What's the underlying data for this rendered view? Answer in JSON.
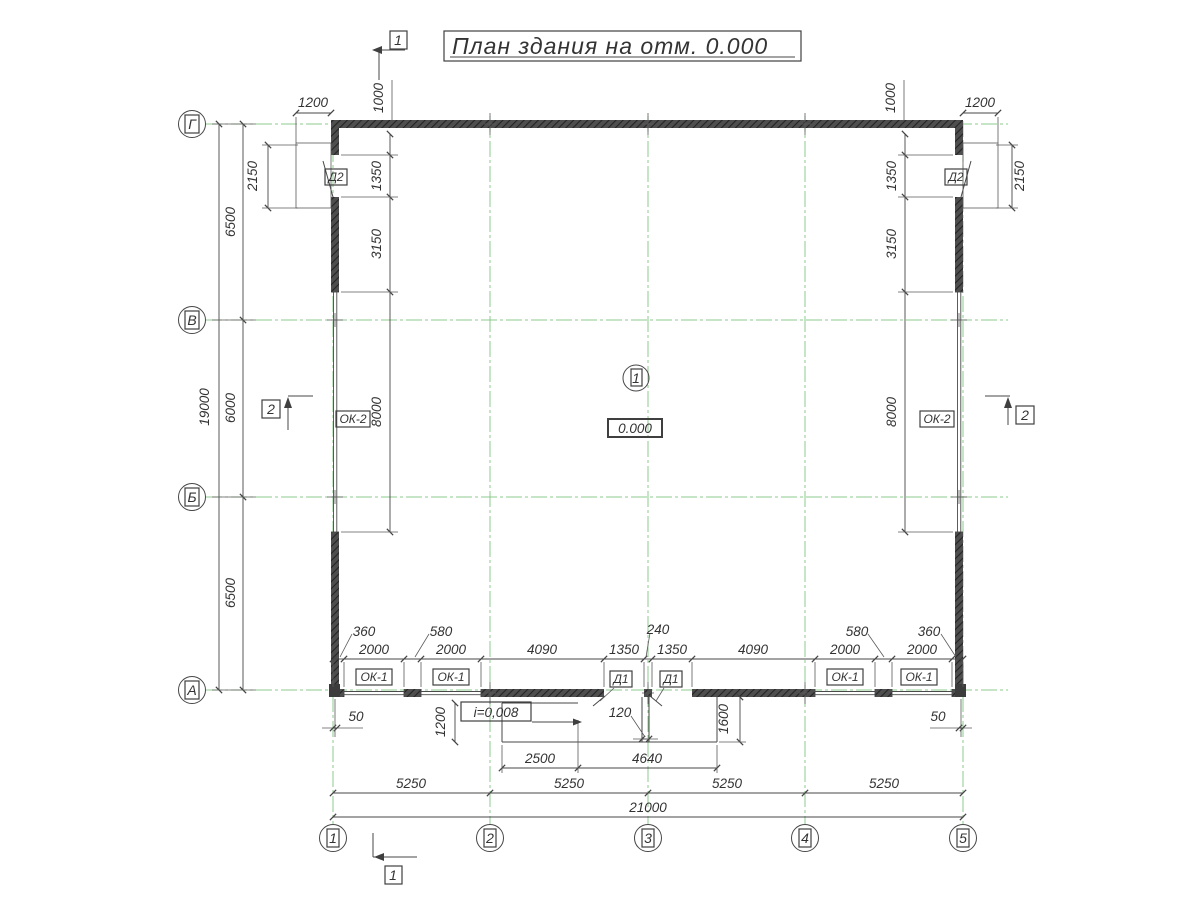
{
  "title": "План здания на отм. 0.000",
  "sections": {
    "s1": "1",
    "s2": "2"
  },
  "axes": {
    "vertical": [
      "Г",
      "В",
      "Б",
      "А"
    ],
    "horizontal": [
      "1",
      "2",
      "3",
      "4",
      "5"
    ]
  },
  "labels": {
    "room_number": "1",
    "elevation": "0.000",
    "slope": "i=0,008",
    "door_main": "Д1",
    "door_side": "Д2",
    "window_large": "ОК-2",
    "window_small": "ОК-1"
  },
  "dims": {
    "total_width": "21000",
    "axis_spans": [
      "5250",
      "5250",
      "5250",
      "5250"
    ],
    "total_height": "19000",
    "row_spans": [
      "6500",
      "6000",
      "6500"
    ],
    "landing_height": "2150",
    "landing_width": "1200",
    "top_offset": "1000",
    "side_chain": [
      "1350",
      "3150",
      "8000"
    ],
    "bottom_chain": [
      "360",
      "2000",
      "580",
      "2000",
      "4090",
      "1350",
      "240",
      "1350",
      "4090",
      "2000",
      "580",
      "2000",
      "360"
    ],
    "wall_axis_offset": "50",
    "ramp_depth_left": "1200",
    "door_step": "120",
    "ramp_depth_right": "1600",
    "ramp_width_left": "2500",
    "ramp_width_right": "4640"
  }
}
